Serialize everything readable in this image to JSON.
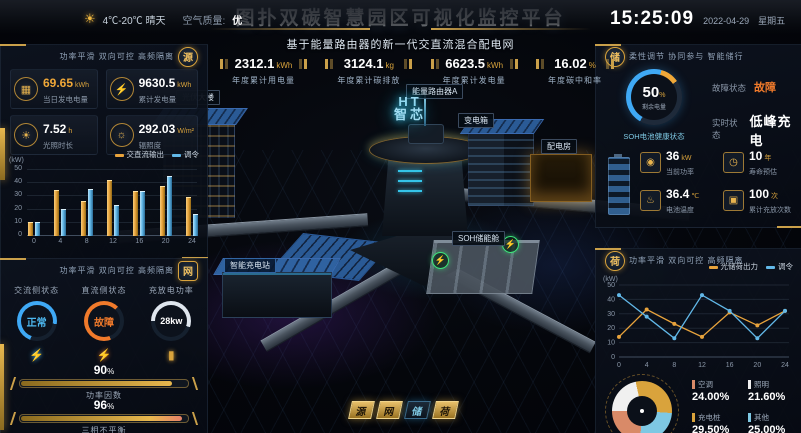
{
  "header": {
    "title": "图扑双碳智慧园区可视化监控平台",
    "subtitle": "基于能量路由器的新一代交直流混合配电网",
    "weather": {
      "range": "4℃-20℃ 晴天",
      "air_label": "空气质量:",
      "air_value": "优"
    },
    "clock": {
      "time": "15:25:09",
      "date": "2022-04-29",
      "weekday": "星期五"
    }
  },
  "top_stats": [
    {
      "value": "2312.1",
      "unit": "kWh",
      "label": "年度累计用电量"
    },
    {
      "value": "3124.1",
      "unit": "kg",
      "label": "年度累计碳排放"
    },
    {
      "value": "6623.5",
      "unit": "kWh",
      "label": "年度累计发电量"
    },
    {
      "value": "16.02",
      "unit": "%",
      "label": "年度碳中和率"
    }
  ],
  "source_panel": {
    "badge": "源",
    "tagline": "功率平滑 双向可控 高频隔离",
    "stats": [
      {
        "value": "69.65",
        "unit": "kWh",
        "label": "当日发电电量"
      },
      {
        "value": "9630.5",
        "unit": "kWh",
        "label": "累计发电量"
      },
      {
        "value": "7.52",
        "unit": "h",
        "label": "光照时长"
      },
      {
        "value": "292.03",
        "unit": "W/m²",
        "label": "辐照度"
      }
    ]
  },
  "grid_panel": {
    "badge": "网",
    "tagline": "功率平滑 双向可控 高频隔离",
    "gauges": [
      {
        "label": "交流侧状态",
        "value": "正常"
      },
      {
        "label": "直流侧状态",
        "value": "故障"
      },
      {
        "label": "充放电功率",
        "value": "28kw"
      }
    ],
    "bars": [
      {
        "value": "90",
        "unit": "%",
        "label": "功率因数",
        "pct": 90
      },
      {
        "value": "96",
        "unit": "%",
        "label": "三相不平衡",
        "pct": 96
      }
    ]
  },
  "storage_panel": {
    "badge": "储",
    "tagline": "柔性调节 协同参与 智能储行",
    "gauge": {
      "value": "50",
      "unit": "%",
      "label": "剩余电量",
      "caption": "SOH电池健康状态"
    },
    "status": [
      {
        "label": "故障状态",
        "value": "故障"
      },
      {
        "label": "实时状态",
        "value": "低峰充电"
      }
    ],
    "stats": [
      {
        "value": "36",
        "unit": "kW",
        "label": "当前功率"
      },
      {
        "value": "10",
        "unit": "年",
        "label": "寿命预估"
      },
      {
        "value": "36.4",
        "unit": "℃",
        "label": "电池温度"
      },
      {
        "value": "100",
        "unit": "次",
        "label": "累计充放次数"
      }
    ]
  },
  "load_panel": {
    "badge": "荷",
    "tagline": "功率平滑 双向可控 高频隔离"
  },
  "scene": {
    "labels": {
      "pv_building": "光伏大楼",
      "router_a": "能量路由器A",
      "core_line1": "HT",
      "core_line2": "智芯",
      "transformer": "变电箱",
      "power_room": "配电房",
      "soh_cabin": "SOH储能舱",
      "charging_station": "智能充电站"
    },
    "mode_buttons": [
      "源",
      "网",
      "储",
      "荷"
    ]
  },
  "chart_data": [
    {
      "id": "source_output",
      "type": "bar",
      "title": "交直流输出与调令",
      "ylabel": "(kW)",
      "ylim": [
        0,
        50
      ],
      "ytick_step": 10,
      "categories": [
        0,
        4,
        8,
        12,
        16,
        20,
        24
      ],
      "series": [
        {
          "name": "交直流输出",
          "color": "#e8a33c",
          "values": [
            10,
            34,
            26,
            42,
            33,
            37,
            29
          ]
        },
        {
          "name": "调令",
          "color": "#62b8e8",
          "values": [
            10,
            20,
            35,
            23,
            33,
            45,
            16
          ]
        }
      ],
      "legend_position": "top-right",
      "grid": true
    },
    {
      "id": "load_output",
      "type": "line",
      "title": "光储荷出力与调令",
      "ylabel": "(kW)",
      "ylim": [
        0,
        50
      ],
      "ytick_step": 10,
      "x": [
        0,
        4,
        8,
        12,
        16,
        20,
        24
      ],
      "series": [
        {
          "name": "光储荷出力",
          "color": "#e8a33c",
          "values": [
            14,
            33,
            23,
            14,
            31,
            22,
            32
          ]
        },
        {
          "name": "调令",
          "color": "#62b8e8",
          "values": [
            43,
            28,
            13,
            43,
            32,
            13,
            32
          ]
        }
      ],
      "legend_position": "top-right",
      "grid": true
    },
    {
      "id": "load_breakdown",
      "type": "pie",
      "title": "负荷构成占比",
      "slices": [
        {
          "label": "空调",
          "value": 24.0,
          "display": "24.00%",
          "color": "#d98a68"
        },
        {
          "label": "照明",
          "value": 21.6,
          "display": "21.60%",
          "color": "#f0f0f0"
        },
        {
          "label": "充电桩",
          "value": 29.5,
          "display": "29.50%",
          "color": "#d9a33c"
        },
        {
          "label": "其他",
          "value": 25.0,
          "display": "25.00%",
          "color": "#7ec8e3"
        }
      ]
    }
  ],
  "colors": {
    "accent_gold": "#d9a33c",
    "accent_blue": "#62b8e8",
    "alert_orange": "#f07a2b",
    "normal_blue": "#3fa9f5",
    "charge_green": "#3ce87a"
  }
}
